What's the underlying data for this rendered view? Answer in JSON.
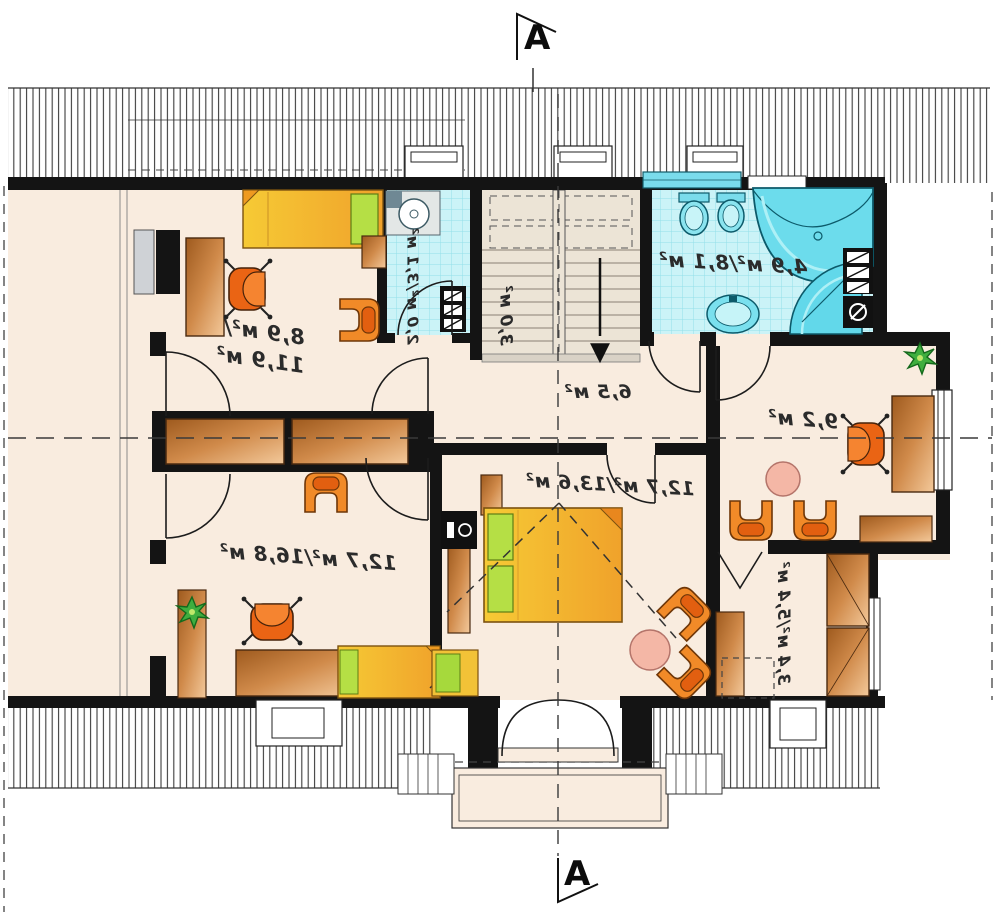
{
  "plan": {
    "section_marker_top": "A",
    "section_marker_bottom": "A",
    "rooms": [
      {
        "name": "bedroom-top-left",
        "area_label_line1": "8,9 м²/",
        "area_label_line2": "11,9 м²"
      },
      {
        "name": "wc",
        "area_label": "2,0 м²/3,1 м²"
      },
      {
        "name": "staircase",
        "area_label": "3,0 м²"
      },
      {
        "name": "hall",
        "area_label": "6,5 м²"
      },
      {
        "name": "bathroom",
        "area_label": "4,9 м²/8,1 м²"
      },
      {
        "name": "office",
        "area_label": "9,2 м²"
      },
      {
        "name": "bedroom-master",
        "area_label": "12,7 м²/13,6 м²"
      },
      {
        "name": "wardrobe",
        "area_label": "3,4 м²/5,4 м²"
      },
      {
        "name": "bedroom-bottom-left",
        "area_label": "12,7 м²/16,8 м²"
      }
    ],
    "icons": {
      "stair_direction_arrow": "▼"
    },
    "colors": {
      "wall": "#141414",
      "floor": "#f9ecdf",
      "tile": "#cbf3f7",
      "furniture_wood": "#c67a38",
      "furniture_orange": "#ee7a1e",
      "bed_yellow": "#f2bf2e",
      "pillow_green": "#b5df45",
      "table_pink": "#f4b7a6",
      "fixture_cyan": "#62d8ea"
    }
  }
}
